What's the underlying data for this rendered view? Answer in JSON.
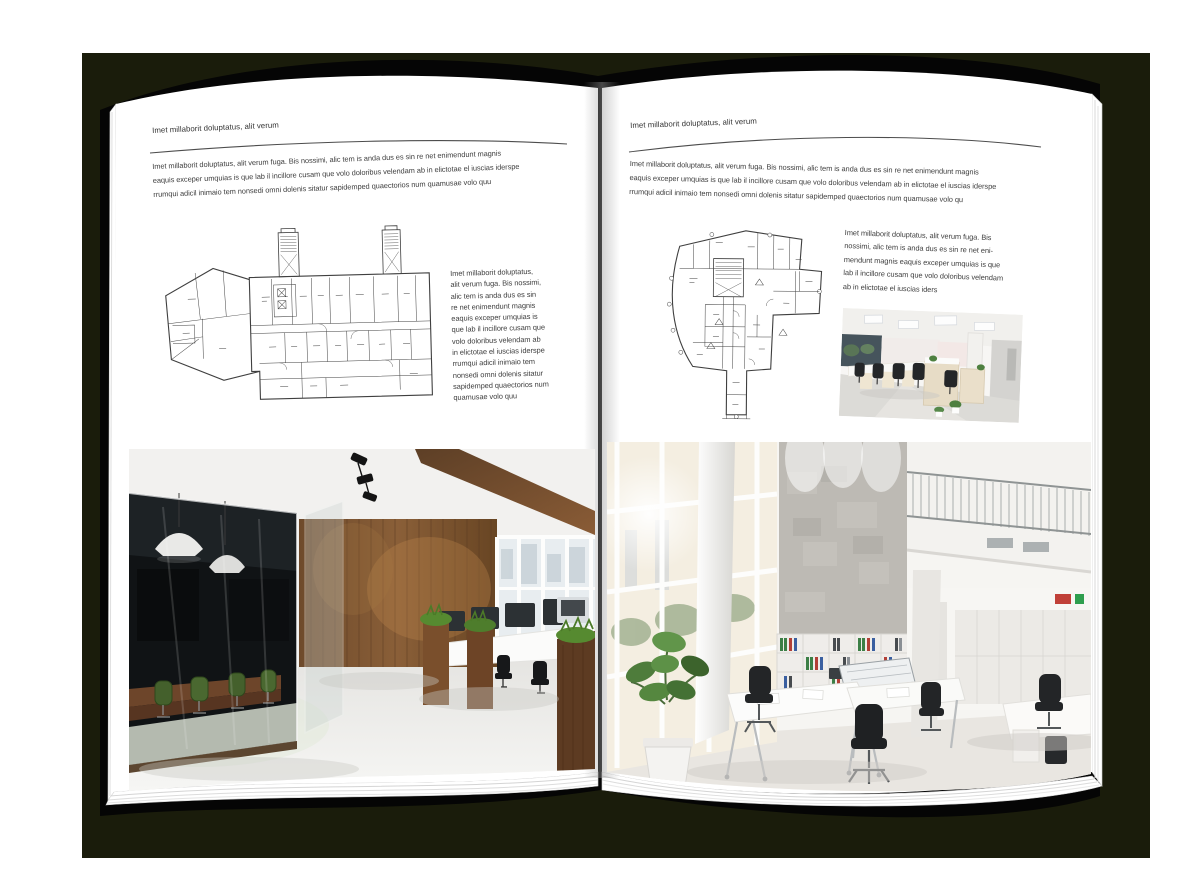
{
  "scene": {
    "backdrop_color": "#1a1c0b",
    "cover_color": "#050505",
    "page_color": "#ffffff",
    "text_color": "#3b3b3b",
    "rule_color": "#4d4d4d"
  },
  "left_page": {
    "header": "Imet millaborit doluptatus, alit verum",
    "intro_lines": [
      "Imet millaborit doluptatus, alit verum fuga. Bis nossimi, alic tem is anda dus es sin re net enimendunt magnis",
      "eaquis exceper umquias is que lab il incillore cusam que volo doloribus velendam ab in elictotae el iuscias iderspe",
      "rrumqui adicil inimaio tem nonsedi omni dolenis sitatur sapidemped quaectorios num quamusae volo quu"
    ],
    "side_lines": [
      "Imet millaborit doluptatus,",
      "alit verum fuga. Bis nossimi,",
      "alic tem is anda dus es sin",
      "re net enimendunt magnis",
      "eaquis exceper umquias is",
      "que lab il incillore cusam que",
      "volo doloribus velendam ab",
      "in elictotae el iuscias iderspe",
      "rrumqui adicil inimaio tem",
      "nonsedi omni dolenis sitatur",
      "sapidemped quaectorios num",
      "quamusae volo quu"
    ]
  },
  "right_page": {
    "header": "Imet millaborit doluptatus, alit verum",
    "intro_lines": [
      "Imet millaborit doluptatus, alit verum fuga. Bis nossimi, alic tem is anda dus es sin re net enimendunt magnis",
      "eaquis exceper umquias is que lab il incillore cusam que volo doloribus velendam ab in elictotae el iuscias iderspe",
      "rrumqui adicil inimaio tem nonsedi omni dolenis sitatur sapidemped quaectorios num quamusae volo qu"
    ],
    "side_lines": [
      "Imet millaborit doluptatus, alit verum fuga. Bis",
      "nossimi, alic tem is anda dus es sin re net eni-",
      "mendunt magnis eaquis exceper umquias is que",
      "lab il incillore cusam que volo doloribus velendam",
      "ab in elictotae el iuscias iders"
    ]
  }
}
